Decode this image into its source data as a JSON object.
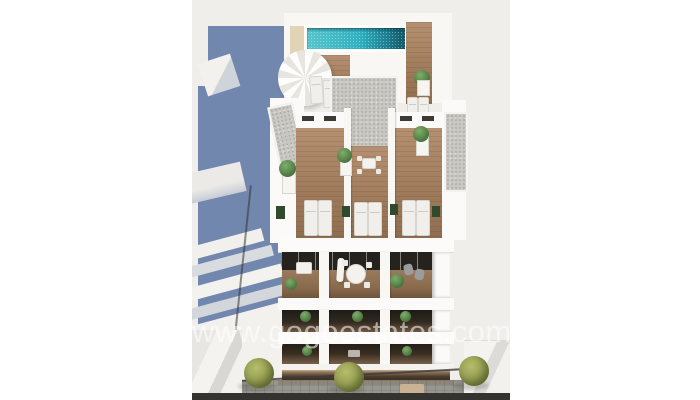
{
  "scene": {
    "type": "architectural-3d-render",
    "description": "Aerial render of a white new-build apartment block with rooftop pool, wooden roof terraces with sun loungers and plants, three floors of balconies, a dark ground floor and a paved street with trees; slate-blue neighbouring building on the left.",
    "watermark": "www.gogoestates.com",
    "colors": {
      "background": "#f0eeea",
      "pool_water": "#2fb0bf",
      "pool_deep_edge": "#14606e",
      "wood_deck": "#a17c5d",
      "gravel_roof": "#c9c7c2",
      "neighbour_building_blue": "#7287ae",
      "pavement_gray": "#98978f",
      "tree_foliage": "#8a9448",
      "watermark_text": "rgba(255,255,255,0.55)"
    }
  }
}
